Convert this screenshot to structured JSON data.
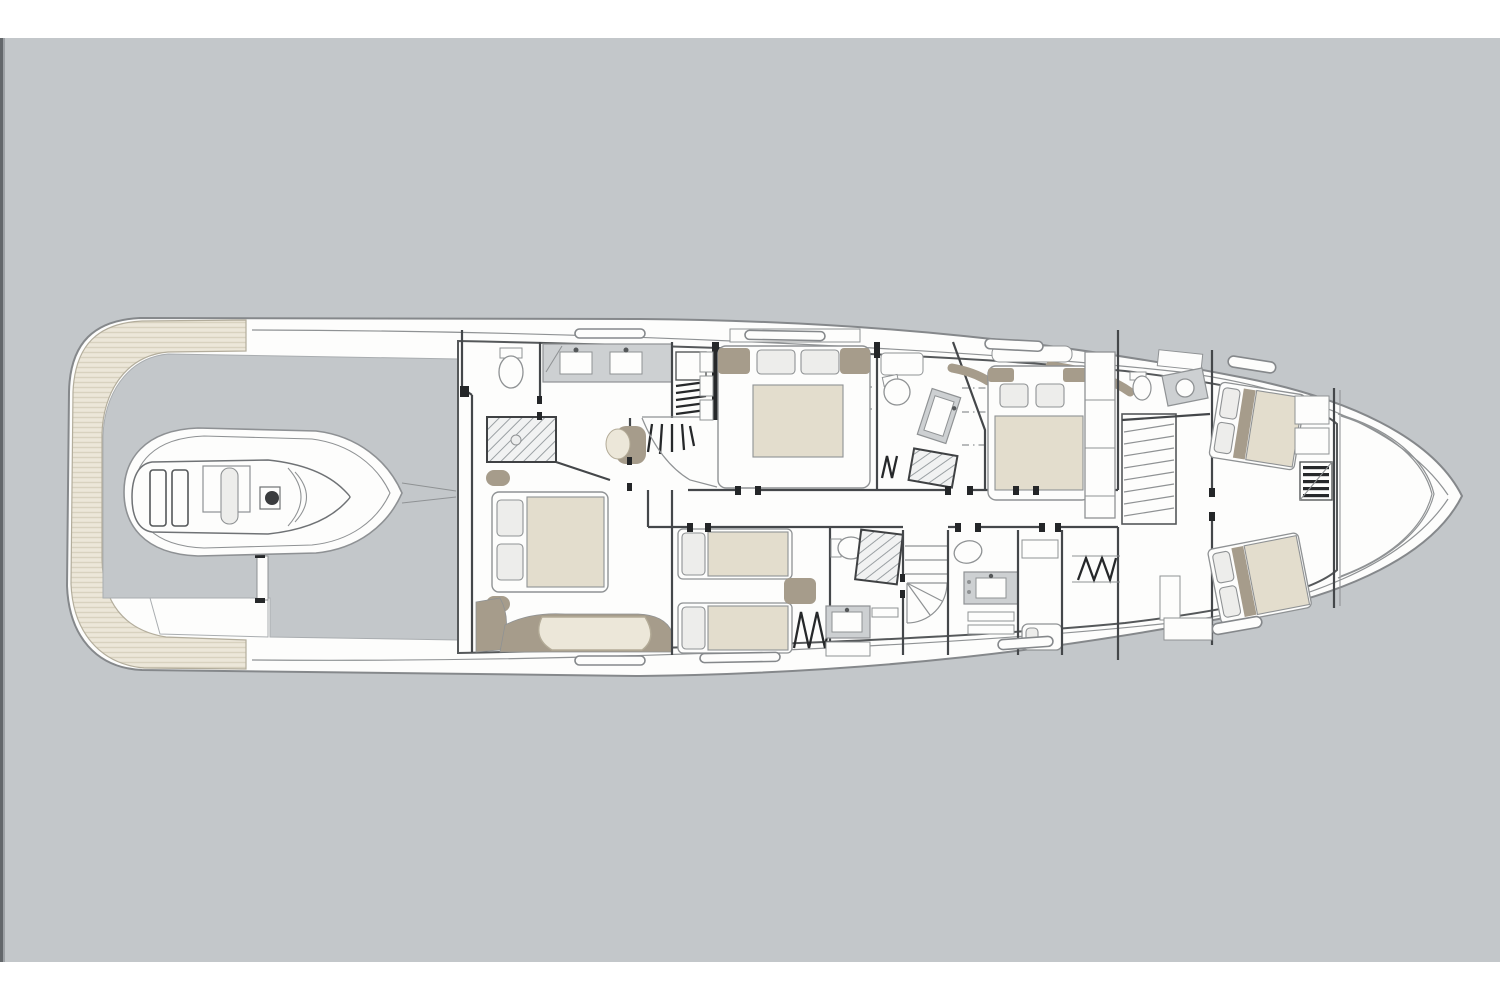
{
  "meta": {
    "description": "Yacht lower deck general-arrangement floor plan, bow to the right, rendered as a technical line drawing on a grey canvas with white bands above and below"
  },
  "canvas": {
    "page_color": "#ffffff",
    "background_color": "#c3c7ca",
    "left_edge_strip_color": "#63676b",
    "top_band_height_px": 38,
    "bottom_band_start_px": 962
  },
  "palette": {
    "page": "#ffffff",
    "bg": "#c3c7ca",
    "edge": "#63676b",
    "edge2": "#9da1a5",
    "white": "#fdfdfc",
    "hullstroke": "#85888b",
    "line": "#8f9294",
    "wall": "#44474a",
    "dark": "#26282a",
    "cream": "#ece7d9",
    "stripe": "#d8d2bf",
    "taupe": "#a69c8b",
    "mattress": "#e3ddcd",
    "pillow": "#ededeb",
    "grayfix": "#cdd0d2"
  },
  "floorplan": {
    "type": "yacht-deck-plan",
    "orientation": "bow-right",
    "rooms": [
      {
        "id": "swim-platform",
        "label": "Teak swim platform wrapping the stern"
      },
      {
        "id": "tender-garage",
        "label": "Aft deck tender garage",
        "items": [
          "personal watercraft / jet tender"
        ]
      },
      {
        "id": "master-cabin",
        "label": "Full-beam master cabin",
        "items": [
          "double bed",
          "curved sofa",
          "ottomans",
          "ensuite WC",
          "twin-sink vanity",
          "shower"
        ]
      },
      {
        "id": "lower-lobby",
        "label": "Lower lobby",
        "items": [
          "armchair",
          "staircase to main deck"
        ]
      },
      {
        "id": "guest-cabin-double",
        "label": "Double guest cabin (aft of amidships, upper side)",
        "items": [
          "double bed",
          "dresser",
          "wardrobe"
        ]
      },
      {
        "id": "guest-bathroom-mid",
        "label": "Guest bathroom amidships",
        "items": [
          "WC",
          "basin",
          "shower"
        ]
      },
      {
        "id": "vip-cabin-forward",
        "label": "Forward VIP cabin",
        "items": [
          "double bed",
          "settee",
          "wardrobe column"
        ]
      },
      {
        "id": "guest-cabin-twin",
        "label": "Twin guest cabin (lower side)",
        "items": [
          "two single beds",
          "nightstand",
          "escape ladder"
        ]
      },
      {
        "id": "guest-bathroom-twin",
        "label": "Twin-cabin bathroom",
        "items": [
          "WC",
          "basin vanity",
          "shower"
        ]
      },
      {
        "id": "spiral-staircase",
        "label": "Spiral staircase"
      },
      {
        "id": "day-head",
        "label": "Day head / crew bathroom",
        "items": [
          "WC",
          "basin vanity"
        ]
      },
      {
        "id": "utility-room",
        "label": "Utility / laundry room"
      },
      {
        "id": "crew-mess",
        "label": "Crew mess with ladder"
      },
      {
        "id": "companionway-stairs",
        "label": "Companionway staircase going down forward"
      },
      {
        "id": "crew-quarters",
        "label": "Crew quarters in the bow",
        "items": [
          "two angled single berths",
          "lockers",
          "crew ladder",
          "crew WC and basin"
        ]
      },
      {
        "id": "forepeak",
        "label": "Forepeak / chain locker behind collision bulkhead"
      }
    ],
    "hull_windows": {
      "top_side": 4,
      "bottom_side": 4
    }
  }
}
